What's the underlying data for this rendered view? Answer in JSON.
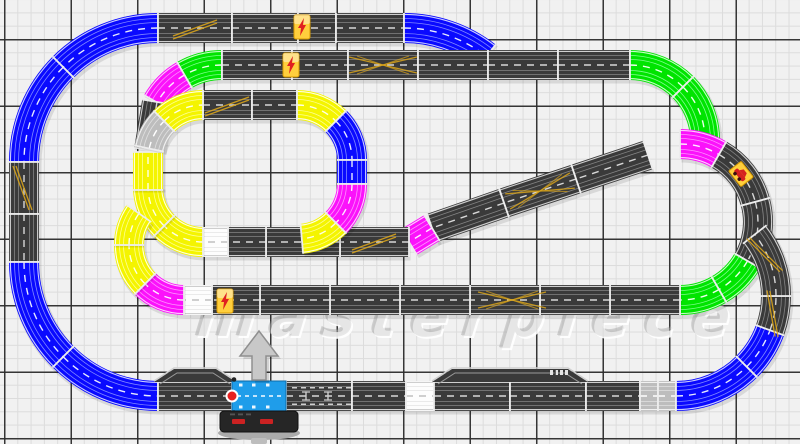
{
  "watermark": {
    "text": "masterpiece"
  },
  "canvas": {
    "width": 800,
    "height": 444,
    "bg": "#f1f1f1",
    "grid": {
      "minor_px": 13.3,
      "major_px": 66.5,
      "minor_color": "#dcdcdc",
      "major_color": "#2d2d2d",
      "offset_x": 4,
      "offset_y": 39
    }
  },
  "palette": {
    "dark": {
      "base": "#3a3a3a",
      "edge": "#e0e0e0",
      "slot": "#8c8c8c",
      "center": "#d8d8d8"
    },
    "blue": {
      "base": "#0a0aff",
      "edge": "#dfe2ff",
      "slot": "#8e97ff",
      "center": "#e6e9ff"
    },
    "green": {
      "base": "#00e400",
      "edge": "#dcffdc",
      "slot": "#8dff9d",
      "center": "#eaffea"
    },
    "yellow": {
      "base": "#f4f400",
      "edge": "#ffffff",
      "slot": "#ffffa2",
      "center": "#ffffe4"
    },
    "magenta": {
      "base": "#fb12fb",
      "edge": "#ffe4ff",
      "slot": "#ff9dff",
      "center": "#ffeaff"
    },
    "silver": {
      "base": "#bdbdbd",
      "edge": "#f6f6f6",
      "slot": "#e4e4e4",
      "center": "#ffffff"
    },
    "white": {
      "base": "#fdfdfd",
      "edge": "#c9c9c9",
      "slot": "#e0e0e0",
      "center": "#c0c0c0"
    }
  },
  "track": {
    "pieces": [
      [
        "a",
        158,
        162,
        134,
        270,
        225,
        "blue"
      ],
      [
        "a",
        158,
        162,
        134,
        225,
        180,
        "blue"
      ],
      [
        "s",
        24,
        162,
        24,
        214,
        "dark"
      ],
      [
        "s",
        24,
        214,
        24,
        262,
        "dark"
      ],
      [
        "a",
        158,
        262,
        134,
        180,
        135,
        "blue"
      ],
      [
        "a",
        158,
        262,
        134,
        135,
        90,
        "blue"
      ],
      [
        "s",
        158,
        28,
        232,
        28,
        "dark"
      ],
      [
        "s",
        232,
        28,
        298,
        28,
        "dark"
      ],
      [
        "s",
        298,
        28,
        336,
        28,
        "dark"
      ],
      [
        "s",
        336,
        28,
        404,
        28,
        "dark"
      ],
      [
        "a",
        404,
        162,
        134,
        270,
        308,
        "blue"
      ],
      [
        "a",
        222,
        140,
        75,
        270,
        240,
        "green"
      ],
      [
        "a",
        222,
        140,
        75,
        240,
        210,
        "magenta"
      ],
      [
        "s",
        157,
        102,
        149,
        150,
        "dark"
      ],
      [
        "s",
        222,
        65,
        292,
        65,
        "dark"
      ],
      [
        "s",
        292,
        65,
        348,
        65,
        "dark"
      ],
      [
        "s",
        348,
        65,
        418,
        65,
        "dark"
      ],
      [
        "s",
        418,
        65,
        488,
        65,
        "dark"
      ],
      [
        "s",
        488,
        65,
        558,
        65,
        "dark"
      ],
      [
        "s",
        558,
        65,
        630,
        65,
        "dark"
      ],
      [
        "a",
        630,
        140,
        75,
        270,
        315,
        "green"
      ],
      [
        "a",
        630,
        140,
        75,
        315,
        0,
        "green"
      ],
      [
        "a",
        680,
        222,
        78,
        270,
        300,
        "magenta"
      ],
      [
        "a",
        680,
        222,
        78,
        300,
        345,
        "dark"
      ],
      [
        "a",
        680,
        222,
        78,
        345,
        30,
        "dark"
      ],
      [
        "a",
        680,
        222,
        78,
        30,
        60,
        "green"
      ],
      [
        "a",
        680,
        222,
        78,
        60,
        90,
        "green"
      ],
      [
        "s",
        648,
        155,
        576,
        179,
        "dark"
      ],
      [
        "s",
        576,
        179,
        504,
        203,
        "dark"
      ],
      [
        "s",
        504,
        203,
        432,
        228,
        "dark"
      ],
      [
        "s",
        432,
        228,
        409,
        242,
        "magenta"
      ],
      [
        "s",
        409,
        242,
        340,
        242,
        "dark"
      ],
      [
        "s",
        340,
        242,
        266,
        242,
        "dark"
      ],
      [
        "s",
        266,
        242,
        228,
        242,
        "dark"
      ],
      [
        "s",
        228,
        242,
        203,
        242,
        "white"
      ],
      [
        "s",
        203,
        105,
        252,
        105,
        "dark"
      ],
      [
        "s",
        252,
        105,
        297,
        105,
        "dark"
      ],
      [
        "a",
        297,
        160,
        55,
        270,
        315,
        "yellow"
      ],
      [
        "a",
        297,
        160,
        55,
        315,
        0,
        "blue"
      ],
      [
        "s",
        352,
        160,
        352,
        184,
        "blue"
      ],
      [
        "a",
        297,
        184,
        55,
        0,
        45,
        "magenta"
      ],
      [
        "a",
        297,
        184,
        55,
        45,
        85,
        "yellow"
      ],
      [
        "a",
        203,
        187,
        55,
        90,
        135,
        "yellow"
      ],
      [
        "a",
        203,
        187,
        55,
        135,
        180,
        "yellow"
      ],
      [
        "s",
        148,
        190,
        148,
        152,
        "yellow"
      ],
      [
        "a",
        203,
        160,
        55,
        192,
        225,
        "silver"
      ],
      [
        "a",
        203,
        160,
        55,
        225,
        270,
        "yellow"
      ],
      [
        "s",
        680,
        300,
        610,
        300,
        "dark"
      ],
      [
        "s",
        610,
        300,
        540,
        300,
        "dark"
      ],
      [
        "s",
        540,
        300,
        470,
        300,
        "dark"
      ],
      [
        "s",
        470,
        300,
        400,
        300,
        "dark"
      ],
      [
        "s",
        400,
        300,
        330,
        300,
        "dark"
      ],
      [
        "s",
        330,
        300,
        260,
        300,
        "dark"
      ],
      [
        "s",
        260,
        300,
        212,
        300,
        "dark"
      ],
      [
        "s",
        212,
        300,
        184,
        300,
        "white"
      ],
      [
        "a",
        184,
        245,
        55,
        90,
        135,
        "magenta"
      ],
      [
        "a",
        184,
        245,
        55,
        135,
        180,
        "yellow"
      ],
      [
        "a",
        184,
        245,
        55,
        180,
        215,
        "yellow"
      ],
      [
        "s",
        158,
        396,
        232,
        396,
        "dark"
      ],
      [
        "s",
        286,
        396,
        352,
        396,
        "dark"
      ],
      [
        "s",
        352,
        396,
        406,
        396,
        "dark"
      ],
      [
        "s",
        406,
        396,
        434,
        396,
        "white"
      ],
      [
        "s",
        434,
        396,
        510,
        396,
        "dark"
      ],
      [
        "s",
        510,
        396,
        586,
        396,
        "dark"
      ],
      [
        "s",
        586,
        396,
        640,
        396,
        "dark"
      ],
      [
        "s",
        640,
        396,
        658,
        396,
        "silver"
      ],
      [
        "s",
        658,
        396,
        676,
        396,
        "silver"
      ],
      [
        "a",
        676,
        296,
        100,
        90,
        45,
        "blue"
      ],
      [
        "a",
        676,
        296,
        100,
        45,
        20,
        "blue"
      ],
      [
        "a",
        676,
        296,
        100,
        20,
        0,
        "dark"
      ],
      [
        "a",
        676,
        296,
        100,
        0,
        322,
        "dark"
      ]
    ],
    "markings": [
      {
        "t": "lc",
        "x": 195,
        "y": 28,
        "r": 0
      },
      {
        "t": "lc",
        "x": 24,
        "y": 188,
        "r": 90
      },
      {
        "t": "lc",
        "x": 227,
        "y": 105,
        "r": 0
      },
      {
        "t": "lc",
        "x": 374,
        "y": 242,
        "r": 0
      },
      {
        "t": "lc",
        "x": 774,
        "y": 314,
        "r": 100
      },
      {
        "t": "lc",
        "x": 766,
        "y": 254,
        "r": 65
      },
      {
        "t": "x",
        "x": 383,
        "y": 65,
        "r": 0
      },
      {
        "t": "x",
        "x": 512,
        "y": 300,
        "r": 0
      },
      {
        "t": "x",
        "x": 540,
        "y": 191,
        "r": 162
      },
      {
        "t": "bolt",
        "x": 302,
        "y": 27,
        "r": 0
      },
      {
        "t": "bolt",
        "x": 291,
        "y": 65,
        "r": 0
      },
      {
        "t": "bolt",
        "x": 225,
        "y": 301,
        "r": 0
      },
      {
        "t": "car",
        "x": 741,
        "y": 174,
        "r": 52
      },
      {
        "t": "pit",
        "x": 320,
        "y": 396,
        "r": 0
      },
      {
        "t": "pitglyph",
        "x": 558,
        "y": 373,
        "r": 0
      }
    ],
    "humps": [
      {
        "x": 156,
        "w": 78,
        "y": 396
      },
      {
        "x": 434,
        "w": 152,
        "y": 396
      }
    ],
    "power_base": {
      "x": 232,
      "y": 381,
      "w": 54,
      "h": 30,
      "color": "#1f9dea",
      "red_dot": {
        "x": 232,
        "y": 396,
        "color": "#e62020"
      },
      "controller": {
        "x": 220,
        "y": 411,
        "w": 78,
        "h": 21,
        "color": "#262626",
        "buttons": "#cc2222"
      },
      "arrow": {
        "cx": 259,
        "tip_y": 331,
        "base_y": 356,
        "head_half": 19,
        "shaft_half": 7,
        "bottom": 380,
        "color": "#c8c8c8"
      }
    }
  }
}
